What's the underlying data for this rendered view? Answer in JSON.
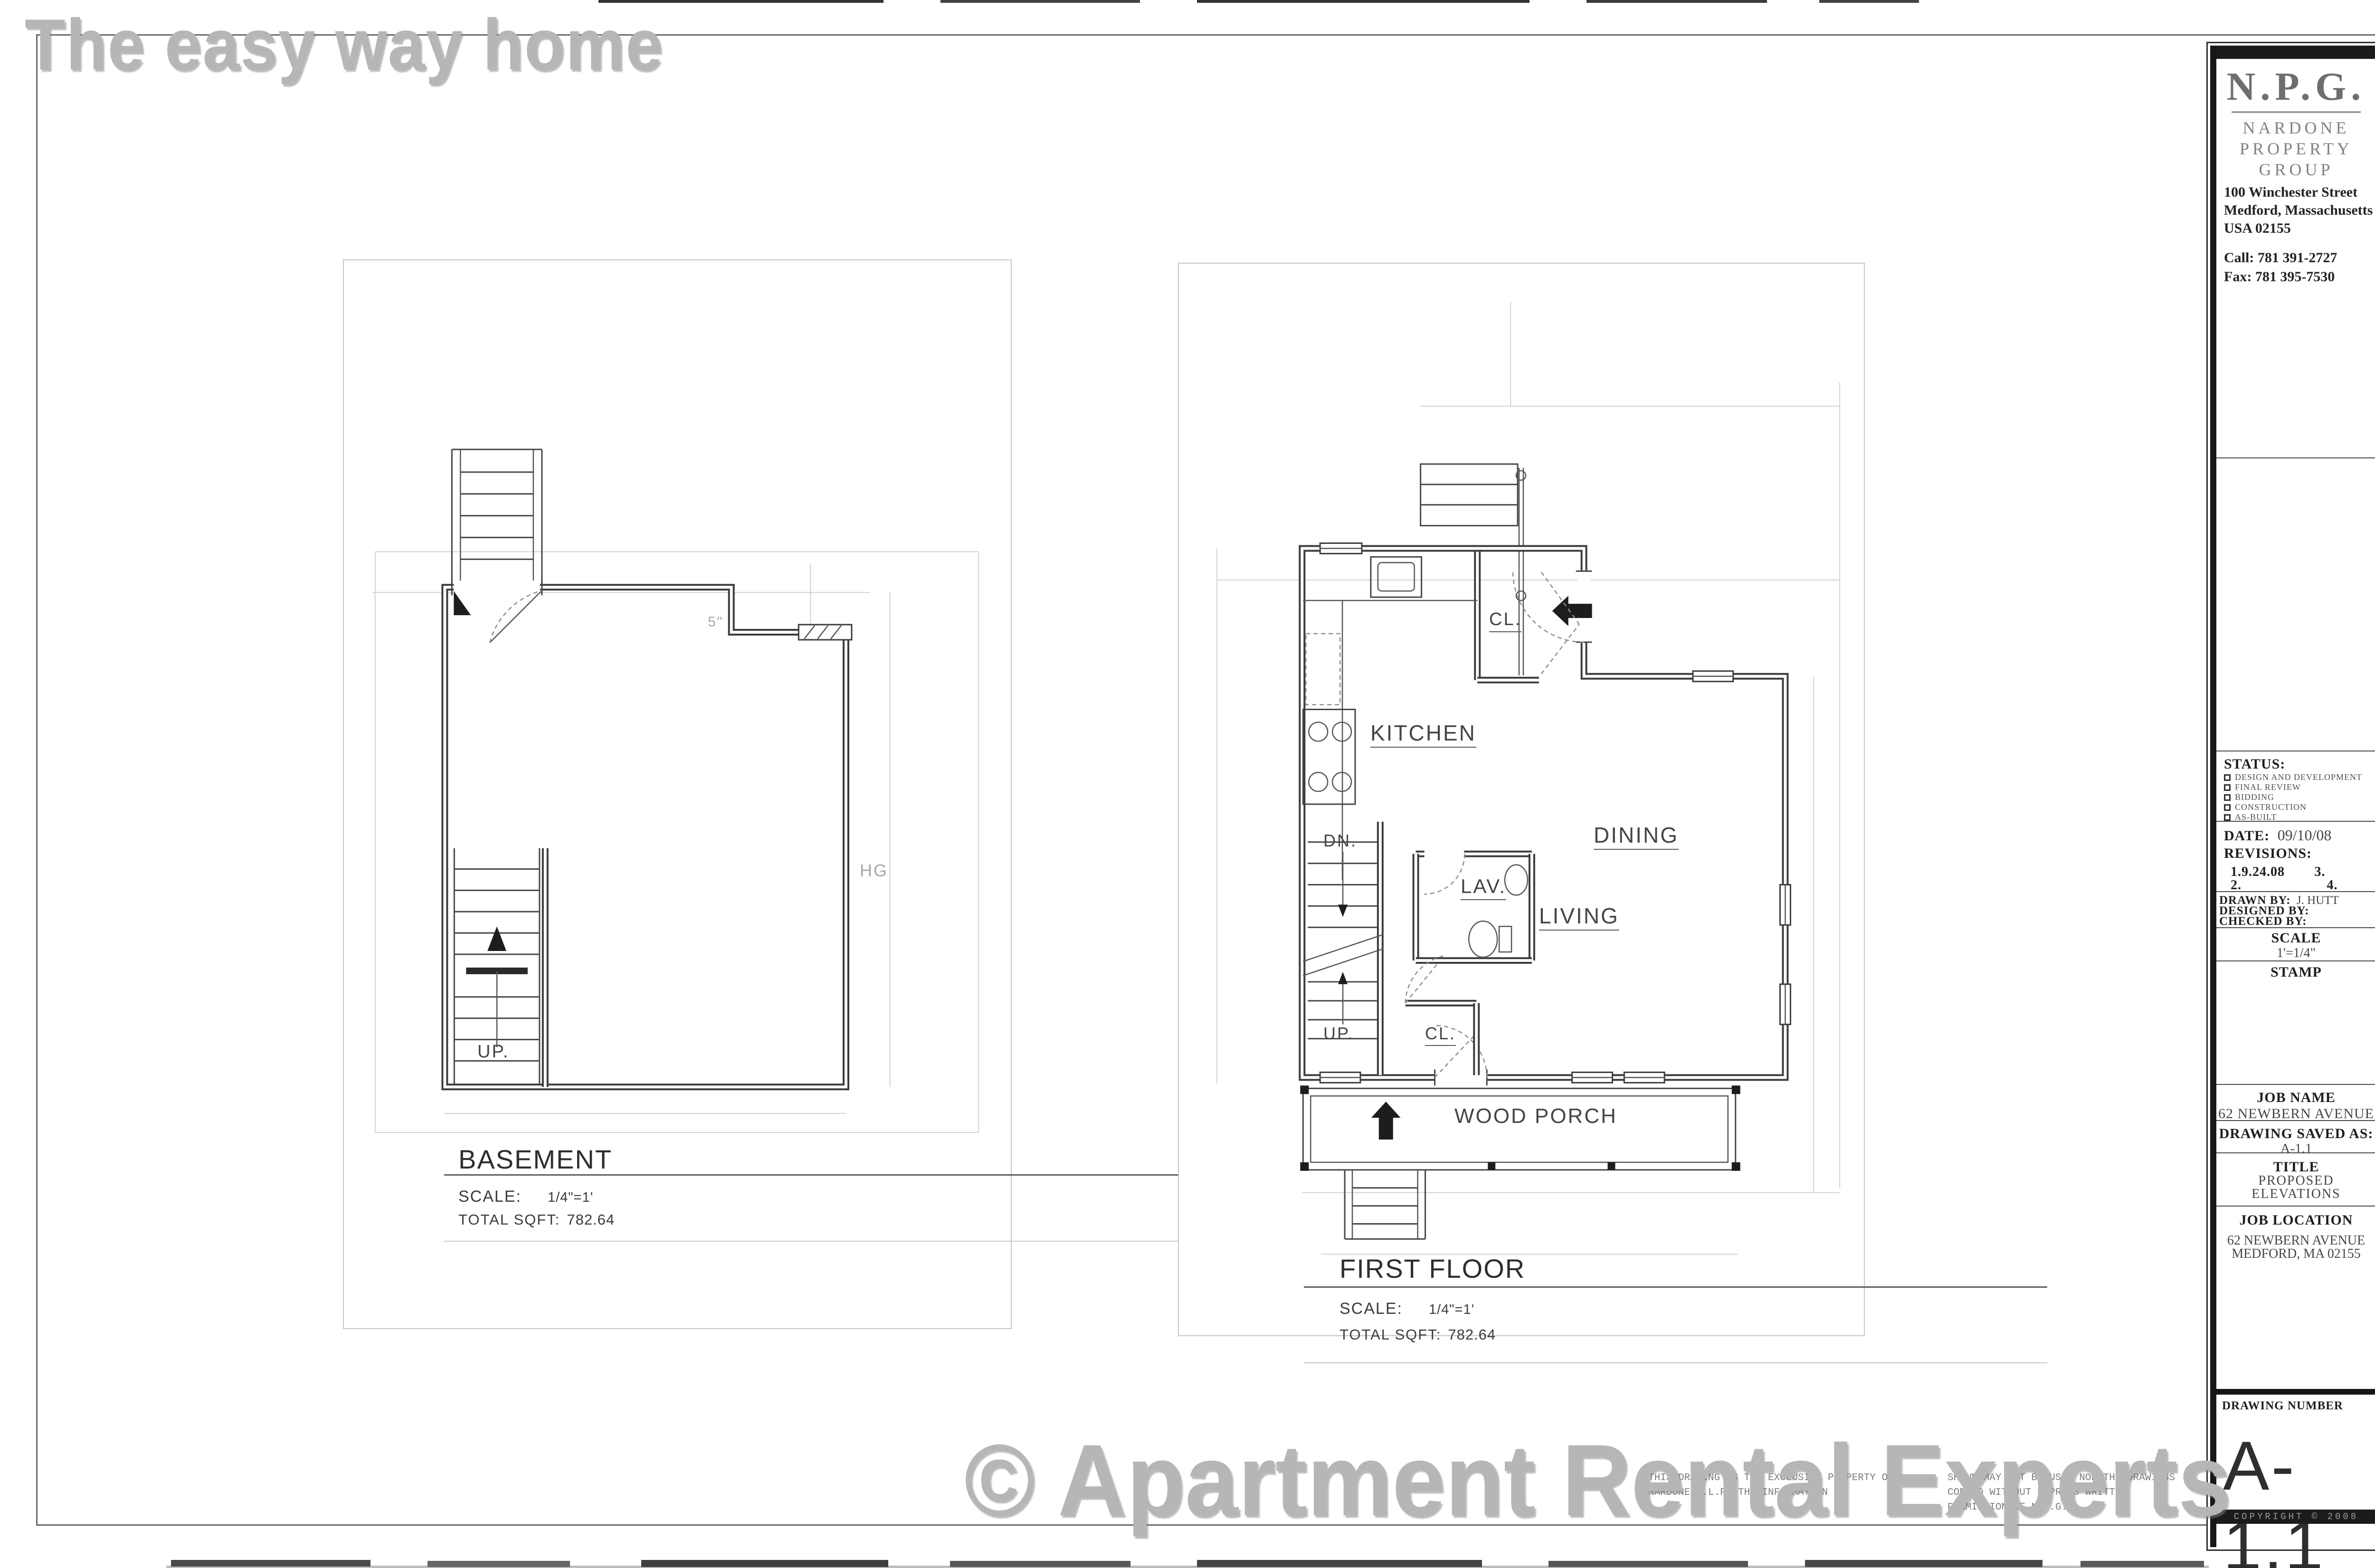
{
  "watermark_top": "The easy way home",
  "watermark_bottom": "© Apartment Rental Experts",
  "basement": {
    "title": "BASEMENT",
    "scale_label": "SCALE:",
    "scale_value": "1/4\"=1'",
    "sqft_label": "TOTAL SQFT:",
    "sqft_value": "782.64",
    "labels": {
      "up": "UP.",
      "note": "HG",
      "dim": "5\""
    }
  },
  "first_floor": {
    "title": "FIRST FLOOR",
    "scale_label": "SCALE:",
    "scale_value": "1/4\"=1'",
    "sqft_label": "TOTAL SQFT:",
    "sqft_value": "782.64",
    "labels": {
      "kitchen": "KITCHEN",
      "dining": "DINING",
      "living": "LIVING",
      "lav": "LAV.",
      "closet_top": "CL.",
      "closet_bottom": "CL.",
      "down": "DN.",
      "up": "UP.",
      "porch": "WOOD PORCH"
    }
  },
  "title_block": {
    "initials": "N.P.G.",
    "company_lines": [
      "NARDONE",
      "PROPERTY",
      "GROUP"
    ],
    "address_lines": [
      "100 Winchester Street",
      "Medford, Massachusetts",
      "USA 02155"
    ],
    "phone": "Call: 781 391-2727",
    "fax": "Fax: 781 395-7530",
    "status_heading": "STATUS:",
    "status_options": [
      "DESIGN AND DEVELOPMENT",
      "FINAL REVIEW",
      "BIDDING",
      "CONSTRUCTION",
      "AS-BUILT"
    ],
    "date_label": "DATE:",
    "date_value": "09/10/08",
    "revisions_heading": "REVISIONS:",
    "rev_1": "1.9.24.08",
    "rev_2": "2.",
    "rev_3": "3.",
    "rev_4": "4.",
    "drawn_by_label": "DRAWN BY:",
    "drawn_by_value": "J. HUTT",
    "designed_by_label": "DESIGNED BY:",
    "checked_by_label": "CHECKED BY:",
    "scale_heading": "SCALE",
    "scale_value": "1'=1/4\"",
    "stamp_heading": "STAMP",
    "job_name_heading": "JOB NAME",
    "job_name_value": "62 NEWBERN AVENUE",
    "saved_as_heading": "DRAWING SAVED AS:",
    "saved_as_value": "A-1.1",
    "title_heading": "TITLE",
    "title_lines": [
      "PROPOSED",
      "ELEVATIONS"
    ],
    "job_location_heading": "JOB LOCATION",
    "job_location_lines": [
      "62 NEWBERN AVENUE",
      "MEDFORD, MA 02155"
    ],
    "drawing_number_heading": "DRAWING NUMBER",
    "drawing_number": "A-1.1",
    "copyright": "COPYRIGHT © 2008"
  },
  "legal": {
    "col1": [
      "THIS DRAWING IS THE EXCLUSIVE PROPERTY OF",
      "NARDONE F.L.P.  THE INFORMATION"
    ],
    "col2": [
      "SHOWN MAY NOT BE USED NOR THE DRAWINGS",
      "COPIED WITHOUT EXPRESS WRITTEN",
      "PERMISSION OF N.P.G."
    ]
  },
  "colors": {
    "wall": "#3c3c3c",
    "faint_line": "#d2d2d2",
    "watermark": "#b6b6b6"
  }
}
